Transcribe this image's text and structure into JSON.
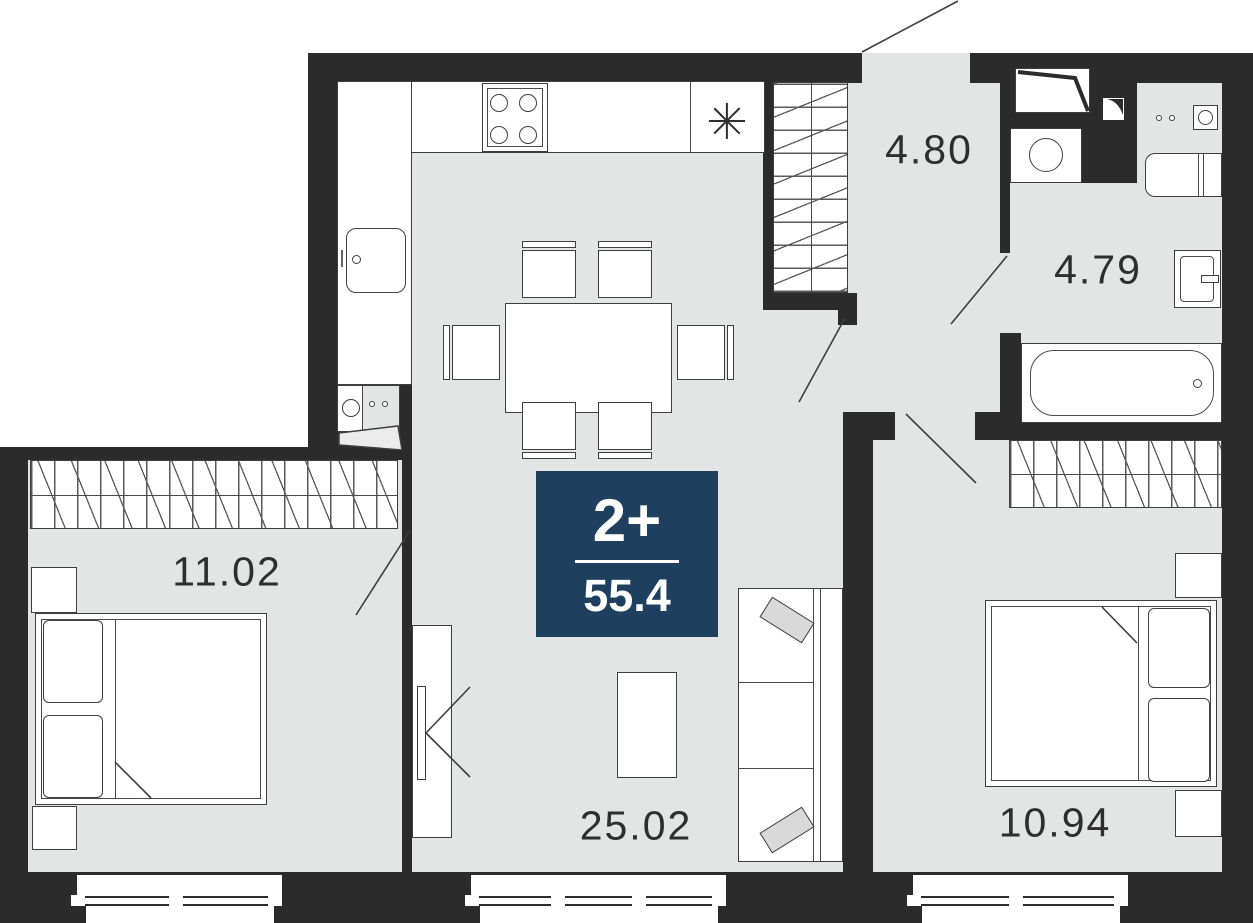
{
  "floorplan": {
    "badge": {
      "label": "2+",
      "area": "55.4"
    },
    "rooms": {
      "hallway": {
        "area": "4.80"
      },
      "bathroom": {
        "area": "4.79"
      },
      "bedroom_left": {
        "area": "11.02"
      },
      "living_kitchen": {
        "area": "25.02"
      },
      "bedroom_right": {
        "area": "10.94"
      }
    },
    "kitchen": {
      "marker_symbol": "asterisk"
    },
    "colors": {
      "wall": "#2b2b2b",
      "floor": "#e3e4e4",
      "badge_background": "#1e405e",
      "furniture_stroke": "#3e3e3e",
      "text": "#2e2e2e"
    }
  }
}
